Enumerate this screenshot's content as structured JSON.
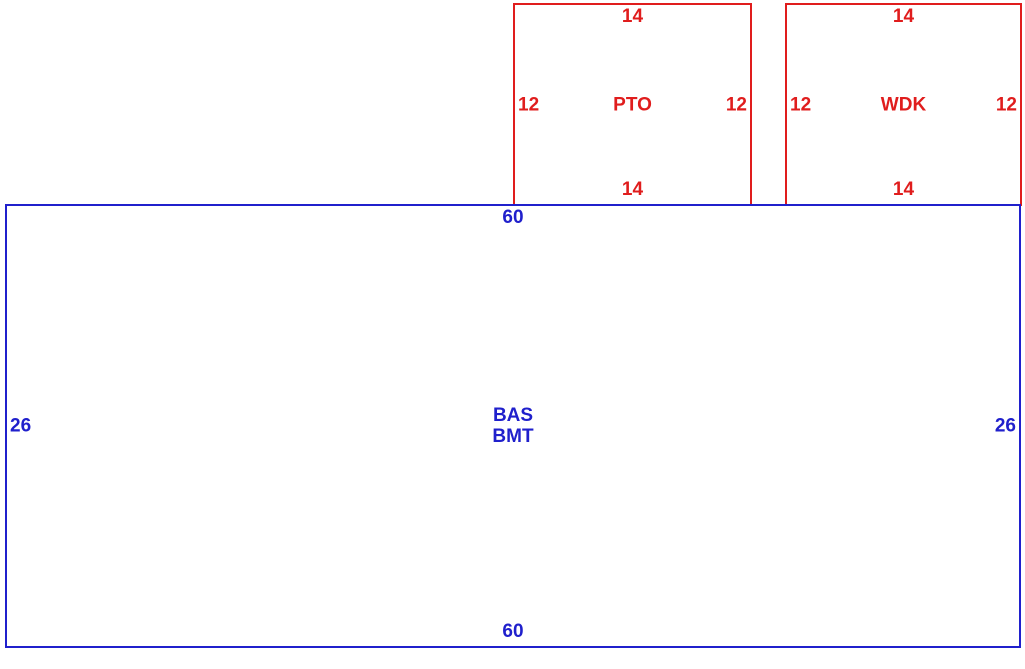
{
  "sketch": {
    "background_color": "#ffffff",
    "colors": {
      "porch_deck_outline": "#e01d1d",
      "base_outline": "#2020cc"
    },
    "areas": [
      {
        "id": "pto",
        "name": "PTO",
        "outline_color": "#e01d1d",
        "dim_top": "14",
        "dim_bottom": "14",
        "dim_left": "12",
        "dim_right": "12"
      },
      {
        "id": "wdk",
        "name": "WDK",
        "outline_color": "#e01d1d",
        "dim_top": "14",
        "dim_bottom": "14",
        "dim_left": "12",
        "dim_right": "12"
      },
      {
        "id": "bas-bmt",
        "name_lines": [
          "BAS",
          "BMT"
        ],
        "outline_color": "#2020cc",
        "dim_top": "60",
        "dim_bottom": "60",
        "dim_left": "26",
        "dim_right": "26"
      }
    ]
  }
}
